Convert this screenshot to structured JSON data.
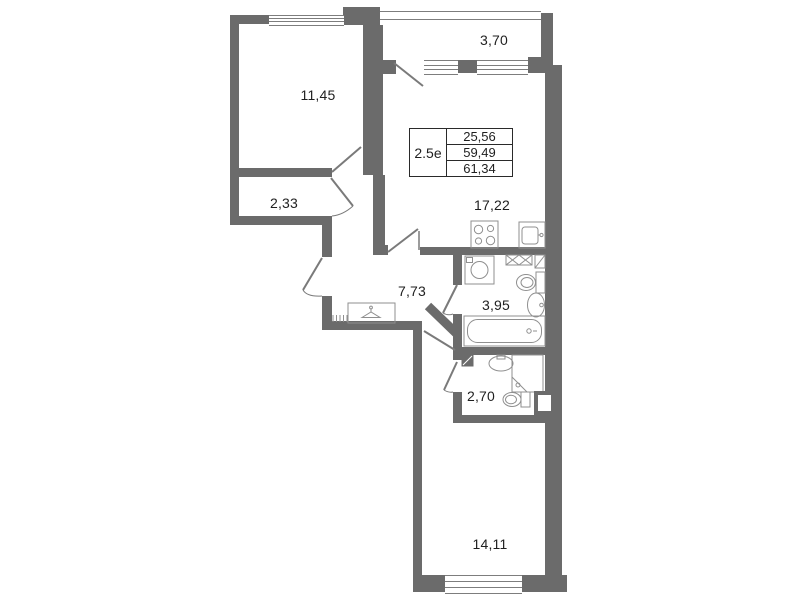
{
  "plan": {
    "title": "apartment-floor-plan",
    "rooms": [
      {
        "name": "bedroom",
        "area": "11,45"
      },
      {
        "name": "balcony",
        "area": "3,70"
      },
      {
        "name": "kitchen-living",
        "area": "17,22"
      },
      {
        "name": "storage",
        "area": "2,33"
      },
      {
        "name": "hallway",
        "area": "7,73"
      },
      {
        "name": "bathroom",
        "area": "3,95"
      },
      {
        "name": "wc",
        "area": "2,70"
      },
      {
        "name": "bedroom-2",
        "area": "14,11"
      }
    ],
    "info_table": {
      "type": "2.5е",
      "values": [
        "25,56",
        "59,49",
        "61,34"
      ]
    },
    "colors": {
      "wall": "#6b6b6b",
      "fixture_line": "#8f8f8f",
      "door_line": "#7a7a7a",
      "text": "#1f1f1f",
      "background": "#ffffff"
    }
  }
}
